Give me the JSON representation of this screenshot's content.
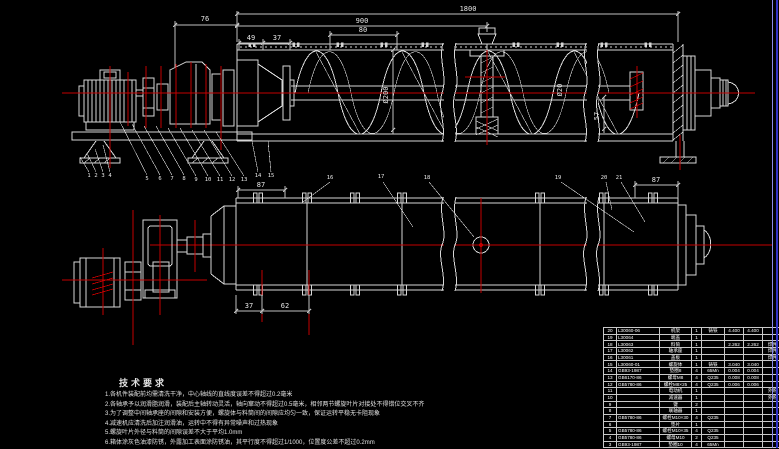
{
  "drawing": {
    "colors": {
      "background": "#000000",
      "line": "#d6d6d6",
      "centerline": "#c40000",
      "frame_border": "#3232c8",
      "text": "#e6e6e6"
    },
    "dimensions": {
      "d1800": "1800",
      "d900": "900",
      "d80": "80",
      "d76": "76",
      "d49": "49",
      "d37_top": "37",
      "dia200": "Ø200",
      "dia20": "Ø20",
      "d57": "57",
      "d87_left": "87",
      "d87_right": "87",
      "d37_bottom": "37",
      "d62": "62"
    },
    "callouts": [
      "1",
      "2",
      "3",
      "4",
      "5",
      "6",
      "7",
      "8",
      "9",
      "10",
      "11",
      "12",
      "13",
      "14",
      "15",
      "16",
      "17",
      "18",
      "19",
      "20",
      "21"
    ],
    "tech": {
      "title": "技术要求",
      "items": [
        "1.各机件装配前均需清洗干净，中心轴线的直线度误差不得超过0.2毫米",
        "2.各轴承予以润滑脂润滑，装配后主轴转动灵活，轴向窜动不得超过0.5毫米，相邻两节螺旋叶片对接处不得错位交叉不齐",
        "3.为了调整中间轴承座的间隙和安装方便，螺旋体与料筒间的间隙应均匀一致，保证运转平稳无卡阻现象",
        "4.减速机应清洗后加注润滑油，运转中不得有异常噪声和过热现象",
        "5.螺旋叶片外径与料筒的间隙误差不大于平均1.0mm",
        "6.箱体涂灰色油漆防锈，外露加工表面涂防锈油，其平行度不得超过1/1000，位置度公差不超过0.2mm"
      ]
    },
    "bom": {
      "rows": [
        {
          "no": "20",
          "code": "L30060-06",
          "name": "机架",
          "qty": "1",
          "material": "铸铁",
          "unit": "4.400",
          "total": "4.400",
          "remark": ""
        },
        {
          "no": "19",
          "code": "L30064",
          "name": "端盖",
          "qty": "1",
          "material": "",
          "unit": "",
          "total": "",
          "remark": ""
        },
        {
          "no": "18",
          "code": "L30063",
          "name": "料筒",
          "qty": "1",
          "material": "",
          "unit": "2.262",
          "total": "2.262",
          "remark": "焊件"
        },
        {
          "no": "17",
          "code": "L30062",
          "name": "轴承座",
          "qty": "1",
          "material": "",
          "unit": "",
          "total": "",
          "remark": "焊件"
        },
        {
          "no": "16",
          "code": "L30061",
          "name": "盖板",
          "qty": "1",
          "material": "",
          "unit": "",
          "total": "",
          "remark": "焊件"
        },
        {
          "no": "15",
          "code": "L30060-01",
          "name": "螺旋体",
          "qty": "1",
          "material": "铸铁",
          "unit": "3.040",
          "total": "3.040",
          "remark": ""
        },
        {
          "no": "14",
          "code": "GB93-1987",
          "name": "垫圈8",
          "qty": "4",
          "material": "65Mn",
          "unit": "0.004",
          "total": "0.004",
          "remark": ""
        },
        {
          "no": "13",
          "code": "GB6170-86",
          "name": "螺母M8",
          "qty": "4",
          "material": "Q235",
          "unit": "0.008",
          "total": "0.008",
          "remark": ""
        },
        {
          "no": "12",
          "code": "GB5780-86",
          "name": "螺栓M8×25",
          "qty": "4",
          "material": "Q235",
          "unit": "0.006",
          "total": "0.006",
          "remark": ""
        },
        {
          "no": "11",
          "code": "",
          "name": "电动机",
          "qty": "1",
          "material": "",
          "unit": "",
          "total": "",
          "remark": "外购"
        },
        {
          "no": "10",
          "code": "",
          "name": "减速器",
          "qty": "1",
          "material": "",
          "unit": "",
          "total": "",
          "remark": "外购"
        },
        {
          "no": "9",
          "code": "",
          "name": "键",
          "qty": "2",
          "material": "",
          "unit": "",
          "total": "",
          "remark": ""
        },
        {
          "no": "8",
          "code": "",
          "name": "联轴器",
          "qty": "1",
          "material": "",
          "unit": "",
          "total": "",
          "remark": ""
        },
        {
          "no": "7",
          "code": "GB5780-86",
          "name": "螺栓M10×30",
          "qty": "4",
          "material": "Q235",
          "unit": "",
          "total": "",
          "remark": ""
        },
        {
          "no": "6",
          "code": "",
          "name": "垫片",
          "qty": "1",
          "material": "",
          "unit": "",
          "total": "",
          "remark": ""
        },
        {
          "no": "5",
          "code": "GB5780-86",
          "name": "螺栓M10×35",
          "qty": "4",
          "material": "Q235",
          "unit": "",
          "total": "",
          "remark": ""
        },
        {
          "no": "4",
          "code": "GB5780-86",
          "name": "螺母M10",
          "qty": "2",
          "material": "Q235",
          "unit": "",
          "total": "",
          "remark": ""
        },
        {
          "no": "3",
          "code": "GB93-1987",
          "name": "垫圈10",
          "qty": "4",
          "material": "65Mn",
          "unit": "",
          "total": "",
          "remark": ""
        }
      ]
    }
  }
}
